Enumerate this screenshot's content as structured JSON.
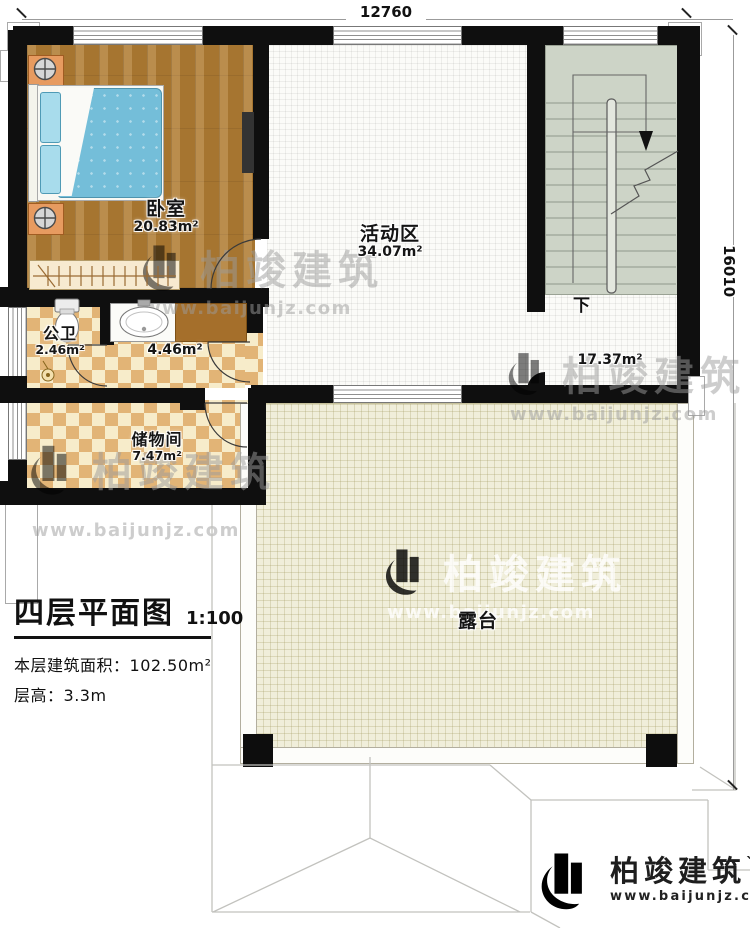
{
  "dimensions": {
    "top": "12760",
    "right": "16010"
  },
  "rooms": {
    "bedroom": {
      "name": "卧室",
      "area": "20.83m²"
    },
    "activity": {
      "name": "活动区",
      "area": "34.07m²"
    },
    "bath": {
      "name": "公卫",
      "area": "2.46m²"
    },
    "corridor": {
      "area": "4.46m²"
    },
    "storage": {
      "name": "储物间",
      "area": "7.47m²"
    },
    "hall": {
      "area": "17.37m²"
    },
    "terrace": {
      "name": "露台"
    }
  },
  "stairs": {
    "down_label": "下"
  },
  "title_block": {
    "title": "四层平面图",
    "scale": "1:100",
    "area_label": "本层建筑面积：",
    "area_value": "102.50m²",
    "height_label": "层高：",
    "height_value": "3.3m"
  },
  "brand": {
    "name": "柏竣建筑",
    "mark": "`",
    "url": "www.baijunjz.com"
  },
  "watermark": {
    "name": "柏竣建筑",
    "url": "www.baijunjz.com"
  },
  "colors": {
    "wall": "#0f0f0f",
    "brand_blue": "#1c5ca6",
    "brand_orange": "#f5a01e",
    "checker_dark": "#e2b476",
    "checker_light": "#f7ecca",
    "stair": "#cdd4c7",
    "terrace": "#f0eeda"
  }
}
